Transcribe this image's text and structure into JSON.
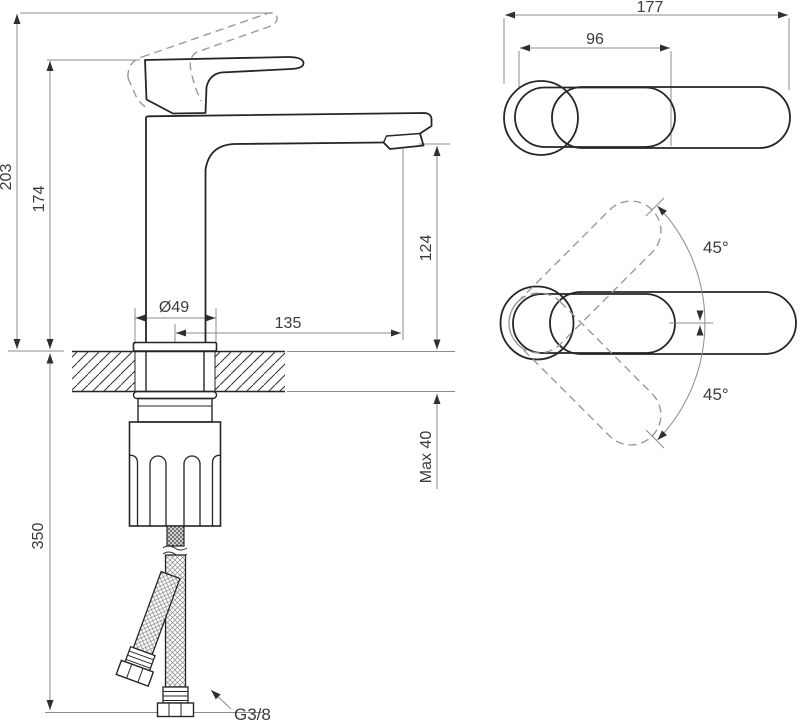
{
  "drawing_title": "Single-lever basin mixer installation drawing",
  "colors": {
    "outline": "#262626",
    "dimension_line": "#8b8b8b",
    "dashed_line": "#9a9a9a",
    "text": "#3b3b3b",
    "background": "#ffffff"
  },
  "side_view": {
    "height_total": "203",
    "height_spout_body": "174",
    "hose_length": "350",
    "base_diameter": "Ø49",
    "spout_reach": "135",
    "outlet_height": "124",
    "deck_thickness_max": "Max 40",
    "hose_thread": "G3/8"
  },
  "top_view": {
    "length_total": "177",
    "handle_length": "96"
  },
  "rotation_view": {
    "angle_up": "45°",
    "angle_down": "45°"
  }
}
